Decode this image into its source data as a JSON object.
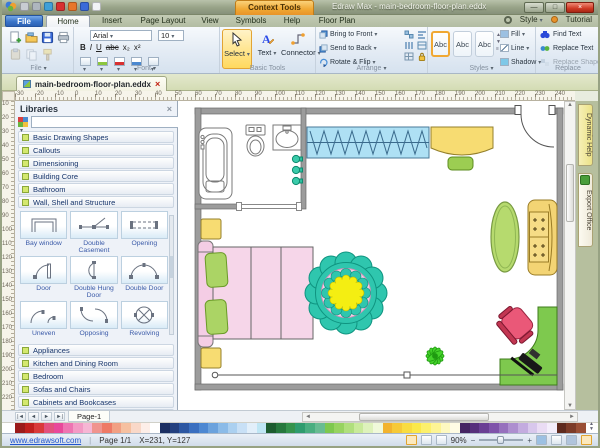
{
  "titlebar": {
    "context_tab": "Context Tools",
    "title": "Edraw Max - main-bedroom-floor-plan.eddx"
  },
  "tabs": {
    "file": "File",
    "items": [
      "Home",
      "Insert",
      "Page Layout",
      "View",
      "Symbols",
      "Help",
      "Floor Plan"
    ],
    "active": "Home",
    "style": "Style",
    "tutorial": "Tutorial"
  },
  "ribbon": {
    "group_labels": {
      "file": "File",
      "font": "Font",
      "basic": "Basic Tools",
      "arrange": "Arrange",
      "styles": "Styles",
      "replace": "Replace"
    },
    "font": {
      "family": "Arial",
      "size": "10",
      "bold": "B",
      "italic": "I",
      "underline": "U",
      "strike": "abc",
      "subscript": "x₂",
      "superscript": "x²"
    },
    "basic": {
      "select": "Select",
      "text": "Text",
      "connector": "Connector"
    },
    "arrange_items": [
      "Bring to Front",
      "Send to Back",
      "Rotate & Flip"
    ],
    "style_preview": "Abc",
    "style_items": [
      "Fill",
      "Line",
      "Shadow"
    ],
    "replace_items": [
      "Find Text",
      "Replace Text",
      "Replace Shape"
    ]
  },
  "document_tab": "main-bedroom-floor-plan.eddx",
  "rulers": {
    "horizontal": [
      "-30",
      "-20",
      "-10",
      "0",
      "10",
      "20",
      "30",
      "40",
      "50",
      "60",
      "70",
      "80",
      "90",
      "100",
      "110",
      "120",
      "130",
      "140",
      "150",
      "160",
      "170",
      "180",
      "190",
      "200",
      "210",
      "220",
      "230",
      "240"
    ],
    "vertical": [
      "10",
      "20",
      "30",
      "40",
      "50",
      "60",
      "70",
      "80",
      "90",
      "100",
      "110",
      "120",
      "130",
      "140",
      "150",
      "160",
      "170",
      "180",
      "190",
      "200",
      "210",
      "220"
    ]
  },
  "libraries": {
    "title": "Libraries",
    "sections_top": [
      "Basic Drawing Shapes",
      "Callouts",
      "Dimensioning",
      "Building Core",
      "Bathroom",
      "Wall, Shell and Structure"
    ],
    "shapes": [
      "Bay window",
      "Double Casement",
      "Opening",
      "Door",
      "Double Hung Door",
      "Double Door",
      "Uneven",
      "Opposing",
      "Revolving"
    ],
    "sections_bottom": [
      "Appliances",
      "Kitchen and Dining Room",
      "Bedroom",
      "Sofas and Chairs",
      "Cabinets and Bookcases",
      "Furniture"
    ]
  },
  "page_bar": {
    "tab": "Page-1"
  },
  "right_tabs": {
    "help": "Dynamic Help",
    "export": "Export Office"
  },
  "palette": [
    "#9b1b1b",
    "#c0201e",
    "#d93a3a",
    "#e2517d",
    "#e8489a",
    "#ee74b2",
    "#f39ac5",
    "#f6b6d4",
    "#f0948e",
    "#ee7a66",
    "#f2a083",
    "#f6c0a0",
    "#f9d8c8",
    "#fdeee8",
    "#ffffff",
    "#1c2f62",
    "#24407f",
    "#2d57a2",
    "#3a6fc0",
    "#4d88d2",
    "#6ba2dd",
    "#8bbbe8",
    "#abd0f0",
    "#c8e0f6",
    "#e2effa",
    "#bfe6f4",
    "#1d5c2f",
    "#27783d",
    "#35934c",
    "#2f9c6e",
    "#4aae80",
    "#68bc92",
    "#7ec84e",
    "#97d360",
    "#b0df7c",
    "#c9ea9a",
    "#def2bb",
    "#f0f9da",
    "#f2b32e",
    "#f6c937",
    "#f9dc40",
    "#fbe94a",
    "#fcf06c",
    "#fdf494",
    "#fef9c0",
    "#fffce4",
    "#452463",
    "#57307c",
    "#6a3f94",
    "#7f53aa",
    "#9670bd",
    "#ad8ecf",
    "#c3abdf",
    "#d8c7ec",
    "#eadcf4",
    "#f4eefb",
    "#5e2a1e",
    "#7c3b28",
    "#9a4f35"
  ],
  "status": {
    "link": "www.edrawsoft.com",
    "page": "Page 1/1",
    "coords": "X=231, Y=127",
    "zoom": "90%"
  }
}
